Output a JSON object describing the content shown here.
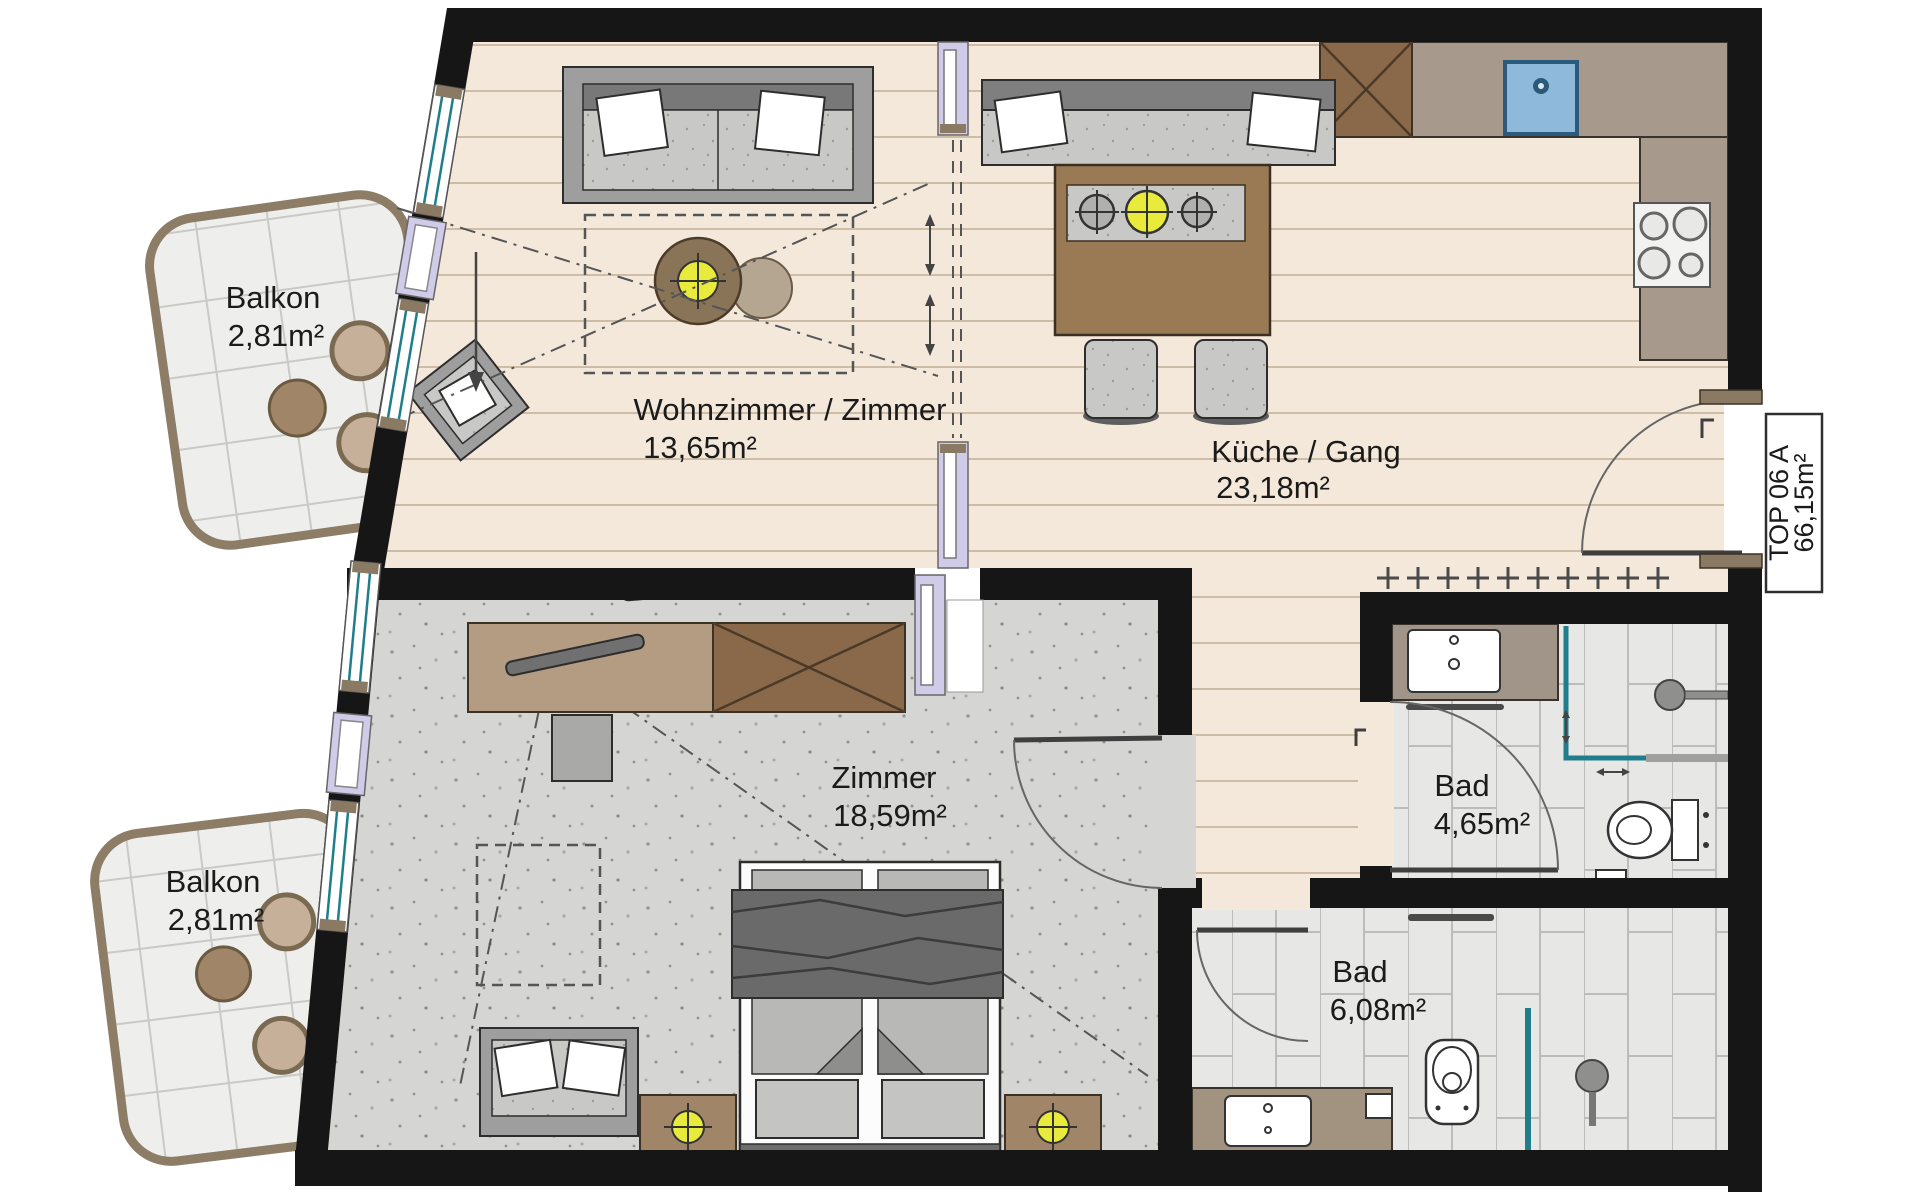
{
  "plan": {
    "unit": {
      "label": "TOP 06 A",
      "area": "66,15m²"
    },
    "rooms": [
      {
        "id": "balkon-top",
        "name": "Balkon",
        "area": "2,81m²"
      },
      {
        "id": "wohnzimmer",
        "name": "Wohnzimmer / Zimmer",
        "area": "13,65m²"
      },
      {
        "id": "kueche",
        "name": "Küche / Gang",
        "area": "23,18m²"
      },
      {
        "id": "zimmer",
        "name": "Zimmer",
        "area": "18,59m²"
      },
      {
        "id": "bad-klein",
        "name": "Bad",
        "area": "4,65m²"
      },
      {
        "id": "bad-gross",
        "name": "Bad",
        "area": "6,08m²"
      },
      {
        "id": "balkon-bottom",
        "name": "Balkon",
        "area": "2,81m²"
      }
    ],
    "colors": {
      "wall": "#161616",
      "floor_main": "#f4e8da",
      "plank_line": "#cdbda7",
      "bedroom_floor": "#d5d5d3",
      "tile": "#e7e7e6",
      "tile_line": "#bcbcba",
      "balcony": "#eeeeec",
      "counter": "#a79a8c",
      "wood": "#8a684a",
      "glass_teal": "#1f7d8c",
      "frame_lavender": "#cfcbe8",
      "lamp_yellow": "#e9eb3c",
      "sink_blue": "#8fb9da",
      "sofa_gray": "#9e9e9e",
      "cushion_gray": "#c8c8c6",
      "dark_object": "#6e6e6e",
      "table_wood": "#997a55"
    }
  }
}
